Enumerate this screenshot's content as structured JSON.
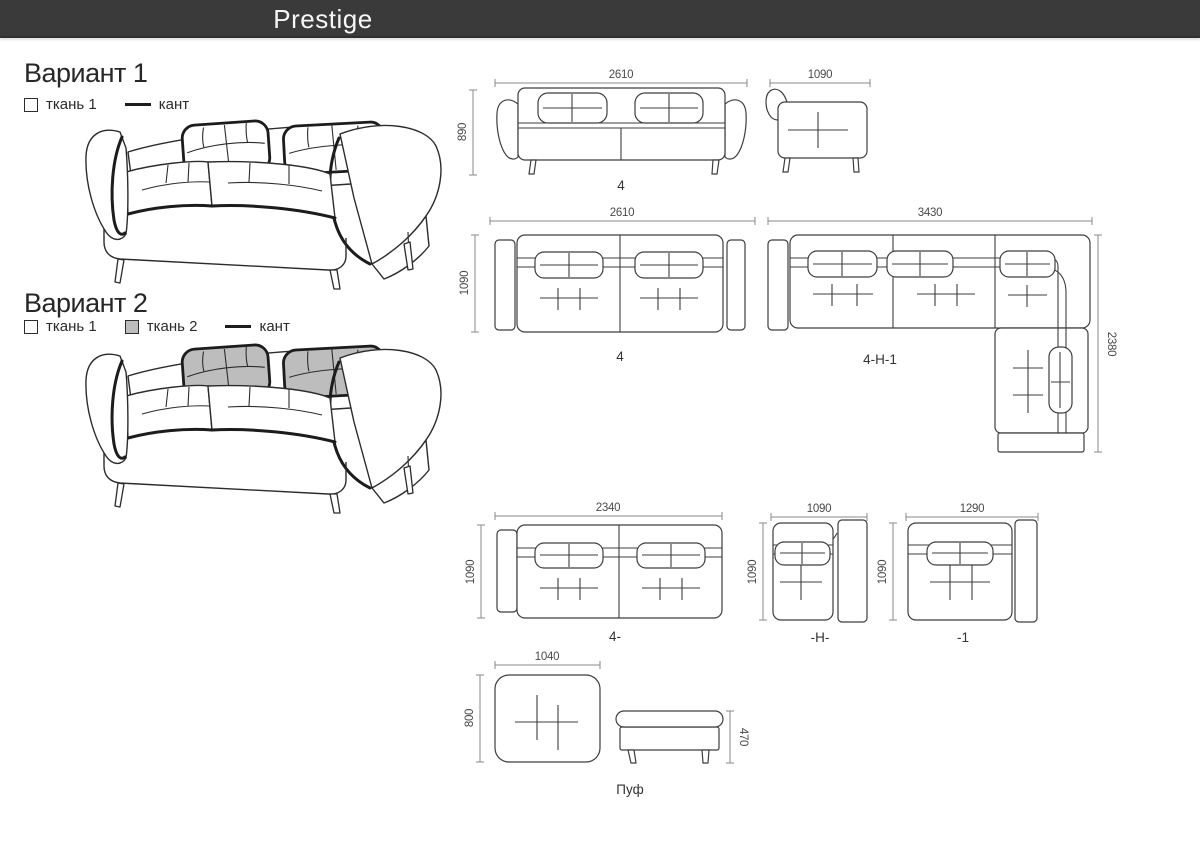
{
  "header": {
    "title": "Prestige"
  },
  "variants": {
    "v1": {
      "title": "Вариант 1",
      "fabric1": "ткань 1",
      "edging": "кант"
    },
    "v2": {
      "title": "Вариант 2",
      "fabric1": "ткань 1",
      "fabric2": "ткань 2",
      "edging": "кант"
    }
  },
  "colors": {
    "header_bg": "#3a3a3a",
    "header_text": "#f6f6f6",
    "fabric2": "#bdbdbd",
    "outline": "#2c2c2c",
    "drawing_line": "#3e3e3e",
    "dim_line": "#8a8a8a",
    "dim_text": "#4a4a4a"
  },
  "drawings": {
    "front": {
      "width": "2610",
      "height": "890",
      "label": "4"
    },
    "side": {
      "width": "1090"
    },
    "plan_4": {
      "width": "2610",
      "depth": "1090",
      "label": "4"
    },
    "plan_corner": {
      "width": "3430",
      "depth": "2380",
      "label": "4-Н-1"
    },
    "plan_4_open": {
      "width": "2340",
      "depth": "1090",
      "label": "4-"
    },
    "plan_h": {
      "width": "1090",
      "depth": "1090",
      "label": "-Н-"
    },
    "plan_1": {
      "width": "1290",
      "depth": "1090",
      "label": "-1"
    },
    "pouf": {
      "top_width": "1040",
      "top_depth": "800",
      "side_height": "470",
      "label": "Пуф"
    }
  }
}
